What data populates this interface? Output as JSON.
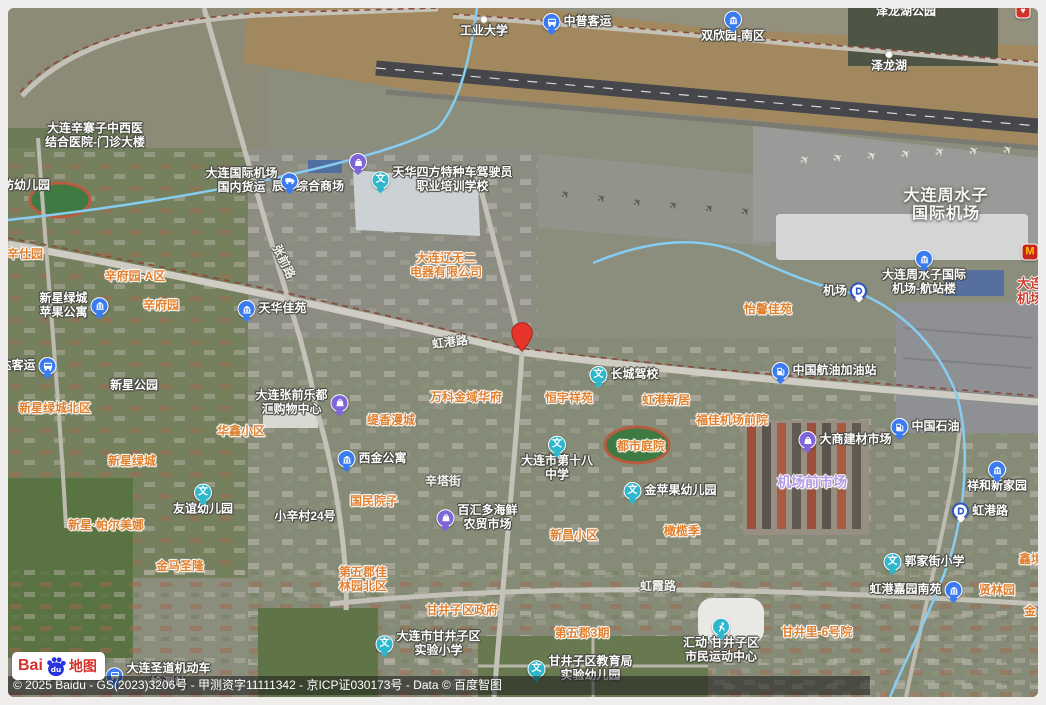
{
  "map": {
    "attribution": "© 2025 Baidu - GS(2023)3206号 - 甲测资字11111342 - 京ICP证030173号 - Data © 百度智图",
    "logo": {
      "bai": "Bai",
      "du": "du",
      "ditu": "地图"
    },
    "pin": {
      "x": 522,
      "y": 352,
      "color": "#e8352c"
    },
    "colors": {
      "poi_blue": "#3b7bf0",
      "edu_teal": "#2fb8cd",
      "shop_purple": "#7e65d9",
      "aoi_orange": "#e0812f",
      "market_purple": "#b49ae8",
      "red_label": "#d03a2e",
      "metro_blue": "#2c57c5",
      "mcd_red": "#c8251d",
      "mcd_yellow": "#ffc300"
    },
    "labels": [
      {
        "id": "gongye-daxue",
        "lines": [
          "工业大学"
        ],
        "x": 484,
        "y": 27,
        "style": "poi",
        "icon": "dot",
        "iconPos": "top"
      },
      {
        "id": "zhongpu-keyun",
        "lines": [
          "中普客运"
        ],
        "x": 577,
        "y": 22,
        "style": "poi",
        "icon": "bus",
        "iconPos": "left"
      },
      {
        "id": "shuangxinyuan-nanqu",
        "lines": [
          "双欣园-南区"
        ],
        "x": 733,
        "y": 27,
        "style": "poi",
        "icon": "building",
        "iconPos": "top"
      },
      {
        "id": "zelonghu-gongyuan",
        "lines": [
          "泽龙湖公园"
        ],
        "x": 906,
        "y": 12,
        "style": "poi"
      },
      {
        "id": "partial-red-marker",
        "lines": [],
        "x": 1023,
        "y": 11,
        "style": "poi",
        "icon": "redpin",
        "iconPos": "left"
      },
      {
        "id": "zelonghu",
        "lines": [
          "泽龙湖"
        ],
        "x": 889,
        "y": 62,
        "style": "poi",
        "icon": "dot",
        "iconPos": "top"
      },
      {
        "id": "xinzhaizi-hospital",
        "lines": [
          "大连辛寨子中西医",
          "结合医院-门诊大楼"
        ],
        "x": 95,
        "y": 136,
        "style": "poi"
      },
      {
        "id": "fang-youeryuan",
        "lines": [
          "坊幼儿园"
        ],
        "x": 26,
        "y": 186,
        "style": "poi"
      },
      {
        "id": "chenhua-shop-icon",
        "lines": [],
        "x": 358,
        "y": 162,
        "style": "poi",
        "icon": "shop",
        "iconPos": "left"
      },
      {
        "id": "chenhua-shangchang",
        "lines": [
          "辰华综合商场"
        ],
        "x": 308,
        "y": 187,
        "style": "poi"
      },
      {
        "id": "airport-cargo",
        "lines": [
          "大连国际机场",
          "国内货运"
        ],
        "x": 252,
        "y": 181,
        "style": "poi",
        "icon": "truck",
        "iconPos": "right"
      },
      {
        "id": "tianhua-driving-school",
        "lines": [
          "天华四方特种车驾驶员",
          "职业培训学校"
        ],
        "x": 442,
        "y": 180,
        "style": "poi",
        "icon": "edu",
        "iconPos": "left"
      },
      {
        "id": "liaowuer-electric",
        "lines": [
          "大连辽无二",
          "电器有限公司"
        ],
        "x": 446,
        "y": 266,
        "style": "aoi"
      },
      {
        "id": "zhangqian-road",
        "lines": [
          "张前路"
        ],
        "x": 283,
        "y": 262,
        "style": "road",
        "rot": 64
      },
      {
        "id": "honggang-road",
        "lines": [
          "虹港路"
        ],
        "x": 450,
        "y": 343,
        "style": "road",
        "rot": -7
      },
      {
        "id": "changcheng-jiaxiao",
        "lines": [
          "长城驾校"
        ],
        "x": 624,
        "y": 375,
        "style": "poi",
        "icon": "edu",
        "iconPos": "left"
      },
      {
        "id": "yixin-jiayuan",
        "lines": [
          "怡馨佳苑"
        ],
        "x": 768,
        "y": 310,
        "style": "aoi"
      },
      {
        "id": "hangyou-gas",
        "lines": [
          "中国航油加油站"
        ],
        "x": 824,
        "y": 371,
        "style": "poi",
        "icon": "gas",
        "iconPos": "left"
      },
      {
        "id": "jichang-station",
        "lines": [
          "机场"
        ],
        "x": 845,
        "y": 291,
        "style": "poi",
        "icon": "metro",
        "iconPos": "right"
      },
      {
        "id": "zhoushuizi-airport",
        "lines": [
          "大连周水子",
          "国际机场"
        ],
        "x": 946,
        "y": 206,
        "style": "area"
      },
      {
        "id": "airport-terminal",
        "lines": [
          "大连周水子国际",
          "机场-航站楼"
        ],
        "x": 924,
        "y": 273,
        "style": "poi",
        "icon": "building",
        "iconPos": "top"
      },
      {
        "id": "mcdonalds",
        "lines": [],
        "x": 1030,
        "y": 252,
        "style": "poi",
        "icon": "mcd",
        "iconPos": "left"
      },
      {
        "id": "dalian-jichang-red",
        "lines": [
          "大连",
          "机场"
        ],
        "x": 1030,
        "y": 292,
        "style": "red"
      },
      {
        "id": "xinshiyuan",
        "lines": [
          "辛仕园"
        ],
        "x": 25,
        "y": 255,
        "style": "aoi"
      },
      {
        "id": "xinfuyuan-a",
        "lines": [
          "辛府园-A区"
        ],
        "x": 135,
        "y": 277,
        "style": "aoi"
      },
      {
        "id": "xinxing-apple",
        "lines": [
          "新星绿城",
          "苹果公寓"
        ],
        "x": 74,
        "y": 306,
        "style": "poi",
        "icon": "building",
        "iconPos": "right"
      },
      {
        "id": "xinfuyuan",
        "lines": [
          "辛府园"
        ],
        "x": 161,
        "y": 306,
        "style": "aoi"
      },
      {
        "id": "tianhua-jiayuan",
        "lines": [
          "天华佳苑"
        ],
        "x": 272,
        "y": 309,
        "style": "poi",
        "icon": "building",
        "iconPos": "left"
      },
      {
        "id": "da-keyun",
        "lines": [
          "达客运"
        ],
        "x": 28,
        "y": 366,
        "style": "poi",
        "icon": "bus",
        "iconPos": "right"
      },
      {
        "id": "xinxing-gongyuan",
        "lines": [
          "新星公园"
        ],
        "x": 134,
        "y": 386,
        "style": "poi"
      },
      {
        "id": "xinxing-lvcheng-beiqu",
        "lines": [
          "新星绿城北区"
        ],
        "x": 55,
        "y": 409,
        "style": "aoi"
      },
      {
        "id": "ledohui-mall",
        "lines": [
          "大连张前乐都",
          "汇购物中心"
        ],
        "x": 302,
        "y": 403,
        "style": "poi",
        "icon": "shop",
        "iconPos": "right"
      },
      {
        "id": "huaxin-xiaoqu",
        "lines": [
          "华鑫小区"
        ],
        "x": 241,
        "y": 432,
        "style": "aoi"
      },
      {
        "id": "xinxing-lvcheng",
        "lines": [
          "新星绿城"
        ],
        "x": 132,
        "y": 462,
        "style": "aoi"
      },
      {
        "id": "tixiang-mancheng",
        "lines": [
          "缇香漫城"
        ],
        "x": 391,
        "y": 421,
        "style": "aoi"
      },
      {
        "id": "vanke-jinyu-huafu",
        "lines": [
          "万科金域华府"
        ],
        "x": 466,
        "y": 398,
        "style": "aoi"
      },
      {
        "id": "hengyu-xiangyuan",
        "lines": [
          "恒宇祥苑"
        ],
        "x": 569,
        "y": 399,
        "style": "aoi"
      },
      {
        "id": "honggang-xinju",
        "lines": [
          "虹港新居"
        ],
        "x": 666,
        "y": 401,
        "style": "aoi"
      },
      {
        "id": "fujia-jichang-qianyuan",
        "lines": [
          "福佳机场前院"
        ],
        "x": 732,
        "y": 421,
        "style": "aoi"
      },
      {
        "id": "xijin-gongyu",
        "lines": [
          "西金公寓"
        ],
        "x": 372,
        "y": 459,
        "style": "poi",
        "icon": "building",
        "iconPos": "left"
      },
      {
        "id": "no18-middle-school",
        "lines": [
          "大连市第十八",
          "中学"
        ],
        "x": 557,
        "y": 459,
        "style": "poi",
        "icon": "edu",
        "iconPos": "top"
      },
      {
        "id": "dushi-tingyuan",
        "lines": [
          "都市庭院"
        ],
        "x": 641,
        "y": 447,
        "style": "aoi"
      },
      {
        "id": "dashang-jiancai",
        "lines": [
          "大商建材市场"
        ],
        "x": 845,
        "y": 440,
        "style": "poi",
        "icon": "shop",
        "iconPos": "left"
      },
      {
        "id": "zhongguo-shiyou",
        "lines": [
          "中国石油"
        ],
        "x": 925,
        "y": 427,
        "style": "poi",
        "icon": "gas",
        "iconPos": "left"
      },
      {
        "id": "jichangqian-shichang",
        "lines": [
          "机场前市场"
        ],
        "x": 812,
        "y": 482,
        "style": "market"
      },
      {
        "id": "jinpingguo-kindergarten",
        "lines": [
          "金苹果幼儿园"
        ],
        "x": 670,
        "y": 491,
        "style": "poi",
        "icon": "edu",
        "iconPos": "left"
      },
      {
        "id": "guomin-yuanzi",
        "lines": [
          "国民院子"
        ],
        "x": 374,
        "y": 502,
        "style": "aoi"
      },
      {
        "id": "xinta-street",
        "lines": [
          "辛塔街"
        ],
        "x": 443,
        "y": 482,
        "style": "road"
      },
      {
        "id": "xiaoxincun-24",
        "lines": [
          "小辛村24号"
        ],
        "x": 305,
        "y": 517,
        "style": "poi"
      },
      {
        "id": "youyi-kindergarten",
        "lines": [
          "友谊幼儿园"
        ],
        "x": 203,
        "y": 500,
        "style": "poi",
        "icon": "edu",
        "iconPos": "top"
      },
      {
        "id": "baihuiduo-market",
        "lines": [
          "百汇多海鲜",
          "农贸市场"
        ],
        "x": 477,
        "y": 518,
        "style": "poi",
        "icon": "shop",
        "iconPos": "left"
      },
      {
        "id": "xinxing-paermeina",
        "lines": [
          "新星·帕尔美娜"
        ],
        "x": 106,
        "y": 526,
        "style": "aoi"
      },
      {
        "id": "xinchang-xiaoqu",
        "lines": [
          "新昌小区"
        ],
        "x": 574,
        "y": 536,
        "style": "aoi"
      },
      {
        "id": "ganlan-ji",
        "lines": [
          "橄榄季"
        ],
        "x": 682,
        "y": 532,
        "style": "aoi"
      },
      {
        "id": "jinma-shenglong",
        "lines": [
          "金马圣隆"
        ],
        "x": 180,
        "y": 567,
        "style": "aoi"
      },
      {
        "id": "guojiajie-primary",
        "lines": [
          "郭家街小学"
        ],
        "x": 924,
        "y": 562,
        "style": "poi",
        "icon": "edu",
        "iconPos": "left"
      },
      {
        "id": "xinjing",
        "lines": [
          "鑫境"
        ],
        "x": 1031,
        "y": 560,
        "style": "aoi"
      },
      {
        "id": "hongganglu-station",
        "lines": [
          "虹港路"
        ],
        "x": 980,
        "y": 511,
        "style": "poi",
        "icon": "metro",
        "iconPos": "left"
      },
      {
        "id": "xianghe-xinjiayuan",
        "lines": [
          "祥和新家园"
        ],
        "x": 997,
        "y": 477,
        "style": "poi",
        "icon": "building",
        "iconPos": "top"
      },
      {
        "id": "honggang-jiayuan-nanyuan",
        "lines": [
          "虹港嘉园南苑"
        ],
        "x": 916,
        "y": 590,
        "style": "poi",
        "icon": "building",
        "iconPos": "right"
      },
      {
        "id": "xianlin-yuan",
        "lines": [
          "贤林园"
        ],
        "x": 997,
        "y": 591,
        "style": "aoi"
      },
      {
        "id": "jin-partial",
        "lines": [
          "金"
        ],
        "x": 1030,
        "y": 612,
        "style": "aoi"
      },
      {
        "id": "hongxia-road",
        "lines": [
          "虹霞路"
        ],
        "x": 658,
        "y": 587,
        "style": "road"
      },
      {
        "id": "diwujun-jialinyuan-beiqu",
        "lines": [
          "第五郡佳",
          "林园北区"
        ],
        "x": 363,
        "y": 580,
        "style": "aoi"
      },
      {
        "id": "ganjingzi-government",
        "lines": [
          "甘井子区政府"
        ],
        "x": 462,
        "y": 611,
        "style": "aoi"
      },
      {
        "id": "ganjingzi-experimental-primary",
        "lines": [
          "大连市甘井子区",
          "实验小学"
        ],
        "x": 428,
        "y": 644,
        "style": "poi",
        "icon": "edu",
        "iconPos": "left"
      },
      {
        "id": "diwujun-3qi",
        "lines": [
          "第五郡3期"
        ],
        "x": 582,
        "y": 634,
        "style": "aoi"
      },
      {
        "id": "citizens-sports-center",
        "lines": [
          "汇动·甘井子区",
          "市民运动中心"
        ],
        "x": 721,
        "y": 641,
        "style": "poi",
        "icon": "sport",
        "iconPos": "top"
      },
      {
        "id": "ganjingli-6-hao-yuan",
        "lines": [
          "甘井里-6号院"
        ],
        "x": 817,
        "y": 633,
        "style": "aoi"
      },
      {
        "id": "education-bureau-kindergarten",
        "lines": [
          "甘井子区教育局",
          "实验幼儿园"
        ],
        "x": 580,
        "y": 669,
        "style": "poi",
        "icon": "edu",
        "iconPos": "left"
      },
      {
        "id": "shengdao-vehicle",
        "lines": [
          "大连圣道机动车",
          "检测站"
        ],
        "x": 158,
        "y": 676,
        "style": "poi",
        "icon": "bus",
        "iconPos": "left"
      }
    ]
  }
}
